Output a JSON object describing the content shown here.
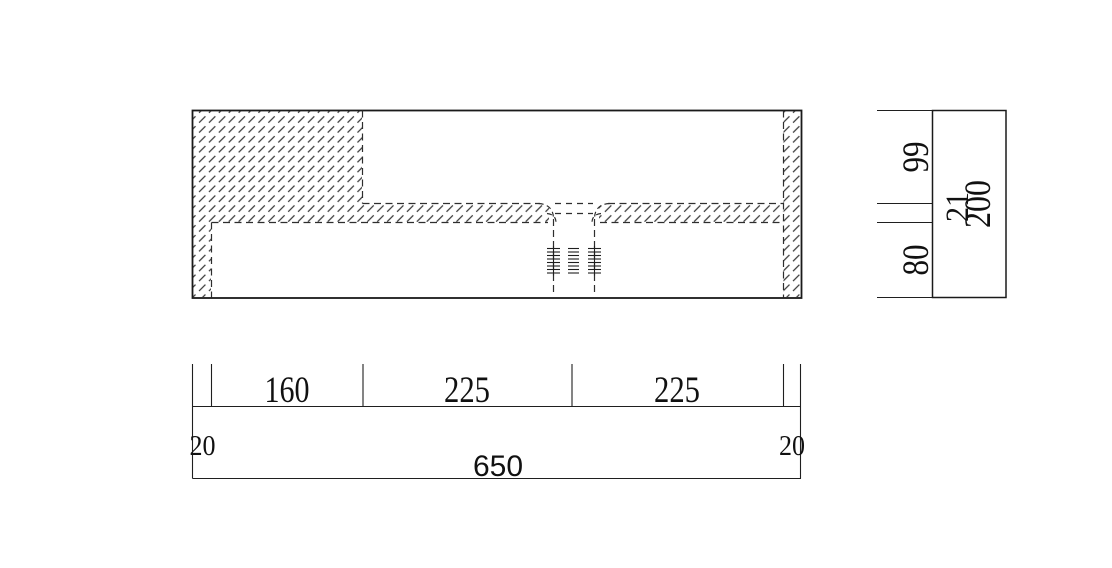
{
  "figure": {
    "type": "technical-drawing-cross-section",
    "front_view": {
      "bottom_dimensions": {
        "left_edge": "20",
        "segment_1": "160",
        "segment_2": "225",
        "segment_3": "225",
        "right_edge": "20",
        "total_width": "650"
      }
    },
    "side_view": {
      "height_dimensions": {
        "upper": "99",
        "middle": "21",
        "lower": "80",
        "total": "200"
      }
    },
    "colors": {
      "line": "#1a1a1a",
      "hidden_line": "#2e2e2e",
      "hatch": "#3a3a3a",
      "background": "#ffffff"
    }
  }
}
